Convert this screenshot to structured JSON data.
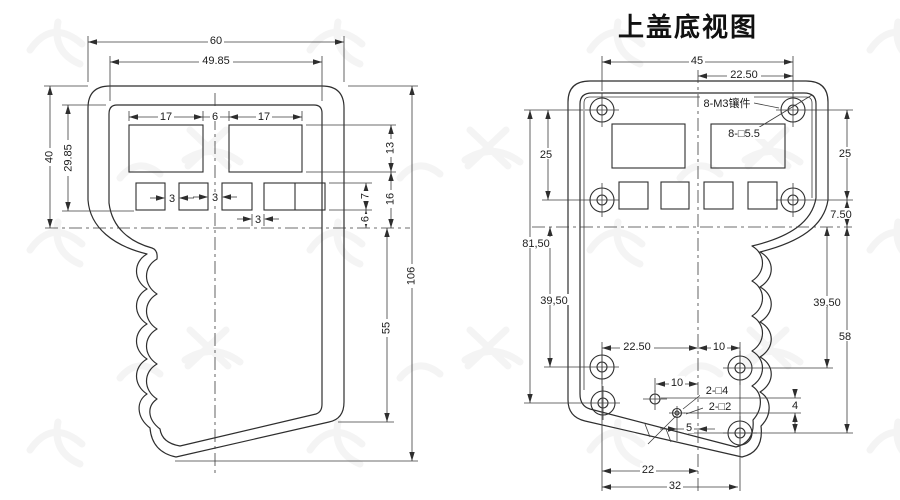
{
  "title": "上盖底视图",
  "left_view": {
    "dims": {
      "total_width": "60",
      "inner_width": "49.85",
      "upper_height": "40",
      "inner_height": "29.85",
      "window_left_w": "17",
      "window_gap": "6",
      "window_right_w": "17",
      "window_h": "13",
      "btn_gap1": "3",
      "btn_gap2": "3",
      "btn_gap3": "3",
      "btn_h": "7",
      "btn_below": "6",
      "win_to_mid": "16",
      "handle_h": "55",
      "total_height": "106"
    }
  },
  "right_view": {
    "labels": {
      "inserts": "8-M3镶件",
      "square_5_5": "8-□5.5",
      "square_4": "2-□4",
      "square_2": "2-□2"
    },
    "dims": {
      "hole_span": "45",
      "hole_half": "22.50",
      "left_25": "25",
      "left_81_50": "81,50",
      "left_39_50": "39,50",
      "right_25": "25",
      "right_7_50": "7.50",
      "right_39_50": "39,50",
      "right_58": "58",
      "bottom_22_50": "22.50",
      "bottom_10": "10",
      "middle_10": "10",
      "vert_4": "4",
      "horiz_5": "5",
      "bottom_22": "22",
      "bottom_32": "32"
    }
  }
}
